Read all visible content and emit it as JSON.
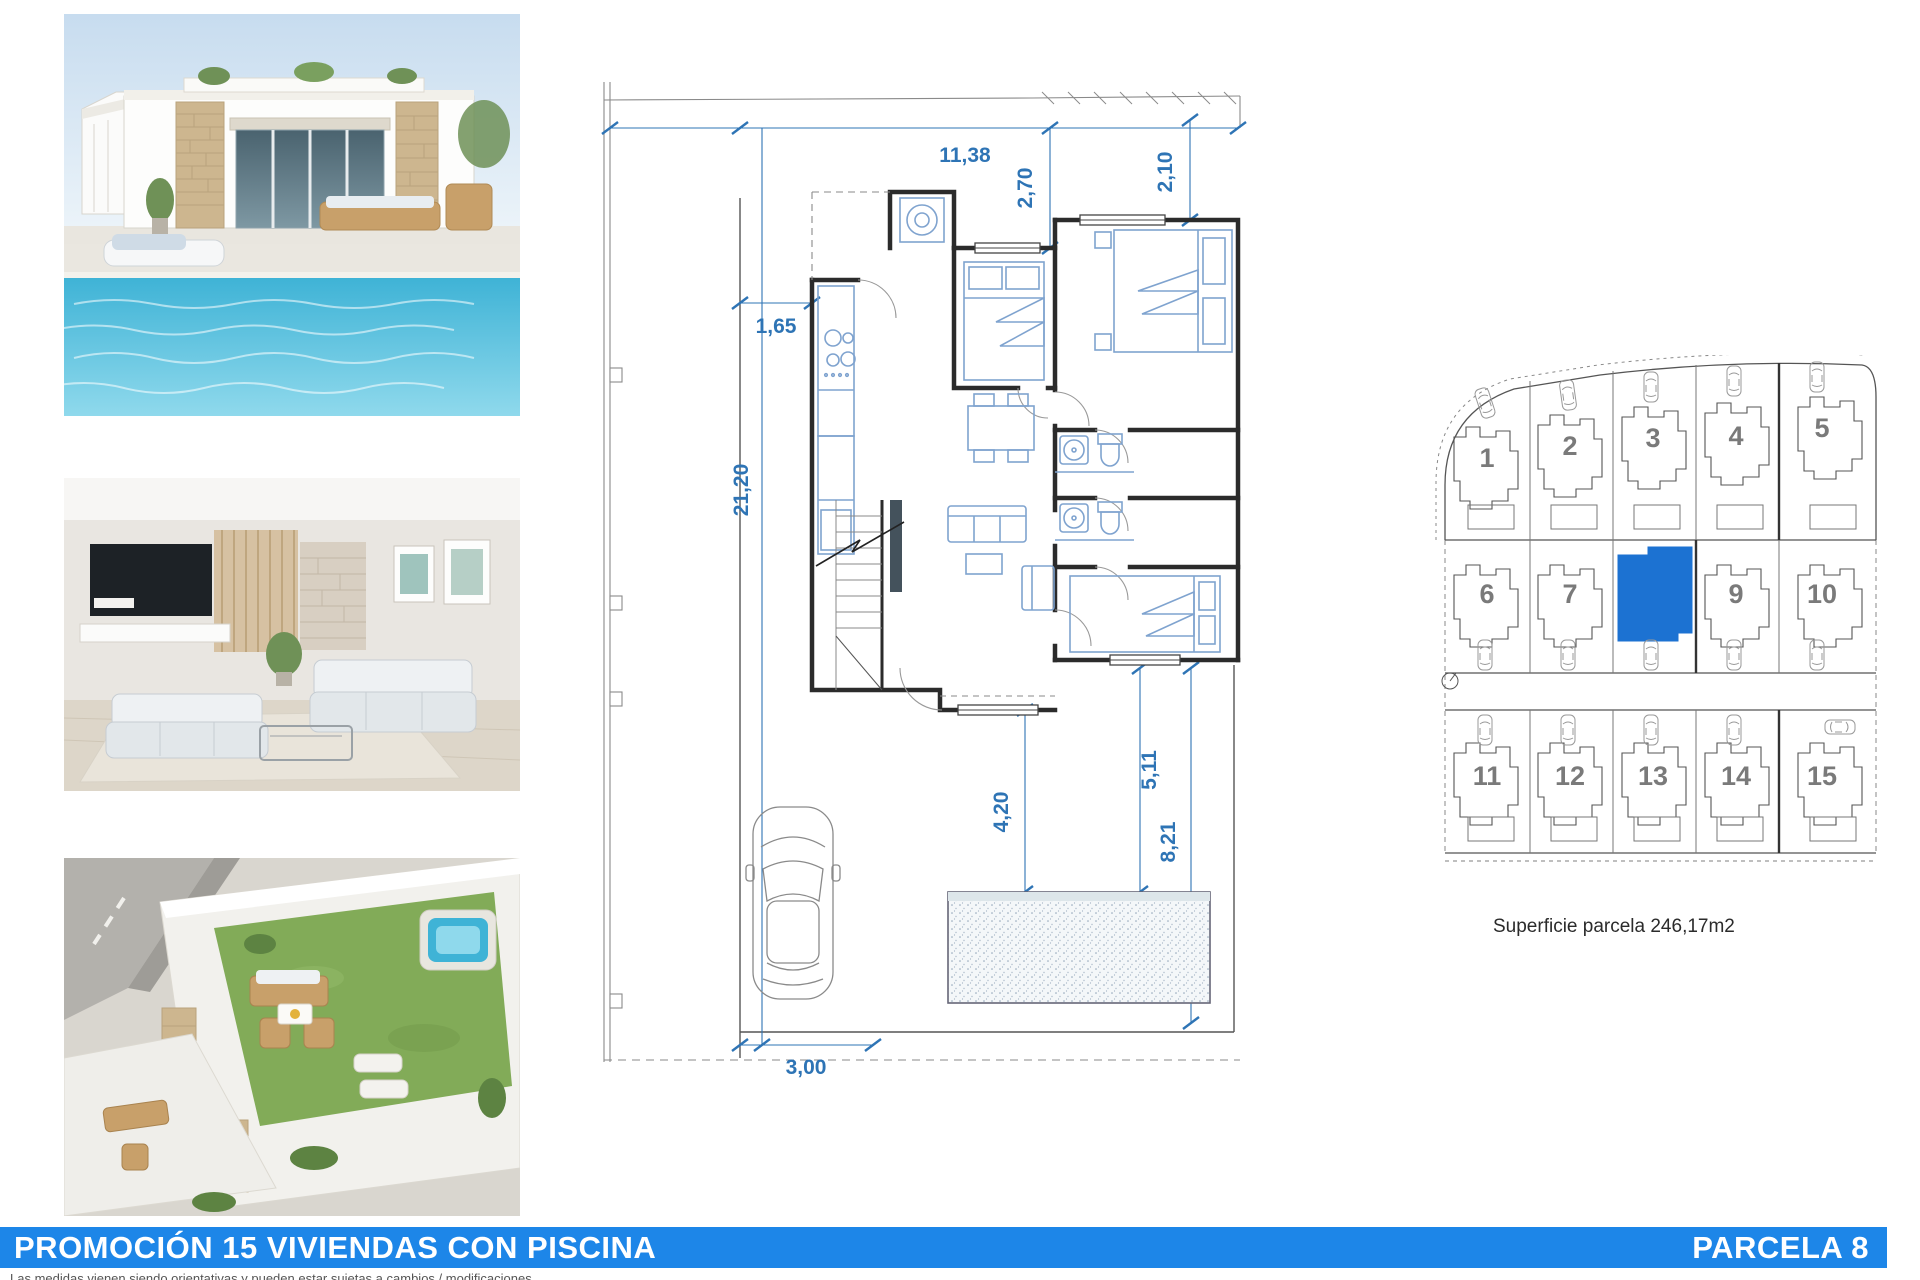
{
  "colors": {
    "accent_blue": "#1d86e8",
    "plot_highlight": "#1c72d2",
    "dimension_blue": "#2e74b5",
    "number_gray": "#7a7a7a"
  },
  "photos": {
    "items": [
      {
        "name": "villa-pool-exterior-render"
      },
      {
        "name": "living-room-interior-render"
      },
      {
        "name": "rooftop-solarium-aerial-render"
      }
    ]
  },
  "floor_plan": {
    "dims": {
      "total_width": "11,38",
      "front_setback_a": "2,70",
      "front_setback_b": "2,10",
      "side_setback": "1,65",
      "plot_depth": "21,20",
      "terrace": "4,20",
      "garden_a": "5,11",
      "garden_b": "8,21",
      "pool": "6,00x 2,50",
      "driveway": "3,00"
    }
  },
  "site_plan": {
    "plots": [
      {
        "n": "1"
      },
      {
        "n": "2"
      },
      {
        "n": "3"
      },
      {
        "n": "4"
      },
      {
        "n": "5"
      },
      {
        "n": "6"
      },
      {
        "n": "7"
      },
      {
        "n": "8"
      },
      {
        "n": "9"
      },
      {
        "n": "10"
      },
      {
        "n": "11"
      },
      {
        "n": "12"
      },
      {
        "n": "13"
      },
      {
        "n": "14"
      },
      {
        "n": "15"
      }
    ],
    "highlighted_plot": "8",
    "caption": "Superficie parcela 246,17m2"
  },
  "footer": {
    "title": "PROMOCIÓN 15 VIVIENDAS CON PISCINA",
    "parcel_label": "PARCELA 8",
    "disclaimer": "Las medidas vienen siendo orientativas y pueden estar sujetas a cambios / modificaciones"
  }
}
